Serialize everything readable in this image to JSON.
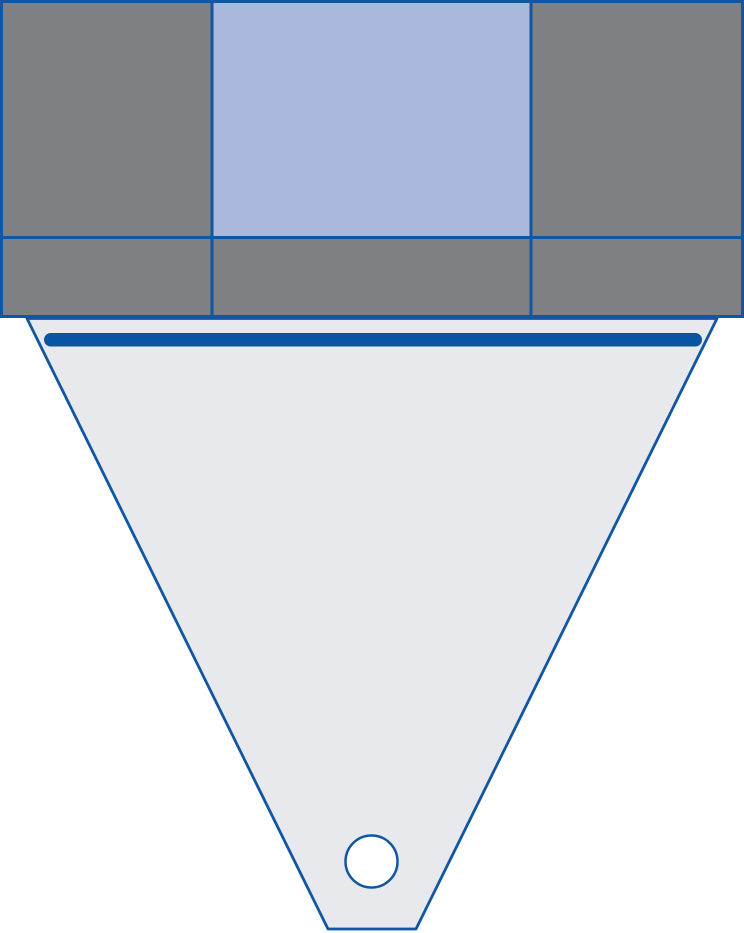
{
  "diagram": {
    "description": "funnel-hopper-schematic",
    "canvas": {
      "width": 744,
      "height": 933,
      "background": "#ffffff"
    },
    "colors": {
      "outline_blue": "#1156a2",
      "bar_blue": "#0a55a3",
      "cell_gray": "#7f8084",
      "cell_light_blue": "#a9b8db",
      "funnel_fill": "#e7e9ec",
      "circle_fill": "#ffffff"
    },
    "shapes": {
      "funnel_body": {
        "points": "27,318.5 717,318.5 416,929 328,929",
        "fill": "#e7e9ec",
        "stroke": "#1156a2",
        "stroke-width": "2.8",
        "stroke-linejoin": "round"
      },
      "grid_cell_r1c1": {
        "x": "1.5",
        "y": "1.5",
        "width": "210.5",
        "height": "236",
        "fill": "#7f8084",
        "stroke": "#1156a2",
        "stroke-width": "3"
      },
      "grid_cell_r1c2": {
        "x": "212",
        "y": "1.5",
        "width": "319",
        "height": "236",
        "fill": "#a9b8db",
        "stroke": "#1156a2",
        "stroke-width": "3"
      },
      "grid_cell_r1c3": {
        "x": "531",
        "y": "1.5",
        "width": "211.5",
        "height": "236",
        "fill": "#7f8084",
        "stroke": "#1156a2",
        "stroke-width": "3"
      },
      "grid_cell_r2c1": {
        "x": "1.5",
        "y": "237.5",
        "width": "210.5",
        "height": "79",
        "fill": "#7f8084",
        "stroke": "#1156a2",
        "stroke-width": "3"
      },
      "grid_cell_r2c2": {
        "x": "212",
        "y": "237.5",
        "width": "319",
        "height": "79",
        "fill": "#7f8084",
        "stroke": "#1156a2",
        "stroke-width": "3"
      },
      "grid_cell_r2c3": {
        "x": "531",
        "y": "237.5",
        "width": "211.5",
        "height": "79",
        "fill": "#7f8084",
        "stroke": "#1156a2",
        "stroke-width": "3"
      },
      "inlet_bar": {
        "x": "44",
        "y": "333",
        "width": "658",
        "height": "13.5",
        "rx": "6.75",
        "fill": "#0a55a3"
      },
      "outlet_circle": {
        "cx": "371.5",
        "cy": "861.5",
        "r": "26",
        "fill": "#ffffff",
        "stroke": "#1156a2",
        "stroke-width": "2.5"
      }
    }
  }
}
